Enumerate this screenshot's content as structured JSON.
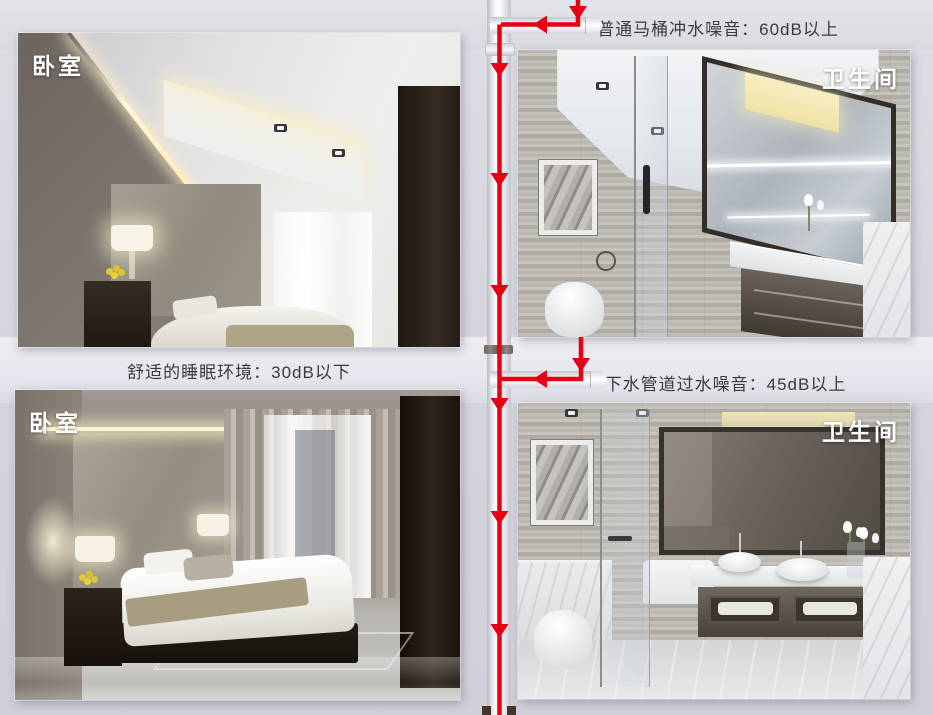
{
  "scene": {
    "rooms": {
      "bedroom_top": {
        "label": "卧室"
      },
      "bathroom_top": {
        "label": "卫生间"
      },
      "bedroom_bottom": {
        "label": "卧室"
      },
      "bathroom_bottom": {
        "label": "卫生间"
      }
    },
    "annotations": {
      "toilet_flush_noise": "普通马桶冲水噪音：60dB以上",
      "sleep_environment": "舒适的睡眠环境：30dB以下",
      "drain_pipe_noise": "下水管道过水噪音：45dB以上"
    },
    "flow": {
      "color": "#e60013",
      "direction": "down"
    },
    "colors": {
      "background": "#d6d6de",
      "band": "#e8e8ee",
      "pipe": "#f4f4f8",
      "label_text": "#ffffff",
      "annotation_text": "#3b3b3d"
    }
  }
}
